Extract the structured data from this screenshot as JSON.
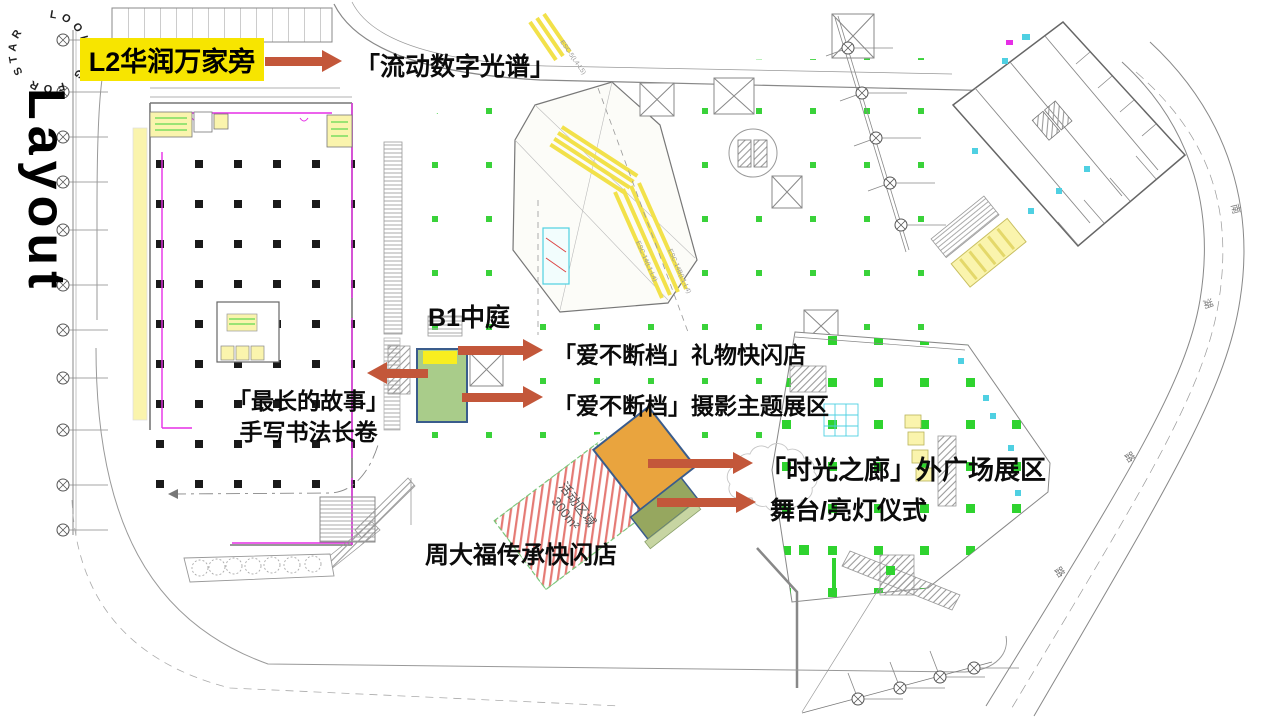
{
  "branding": {
    "circle_text": "LOOKING FOR STAR",
    "side_text": "Layout"
  },
  "colors": {
    "arrow": "#c3573a",
    "highlight": "#f7e500",
    "atrium_green": "#a9cc8a",
    "atrium_border": "#3a5c8c",
    "atrium_yellow": "#f8ee20",
    "corridor_orange": "#e9a43e",
    "stage_green": "#96a75f",
    "stage_strip": "#c7d5a2",
    "hatch_red": "#e0635c",
    "hatch_green": "#7cc87c",
    "cad_magenta": "#e62ee6",
    "cad_green": "#3ad23a",
    "cad_bright_green": "#2fd32f",
    "cad_cyan": "#4fd0e2",
    "cad_yellow": "#f2e14a",
    "cad_yellow_fill": "#faf4ad"
  },
  "annotations": {
    "l2_entry": "L2华润万家旁",
    "digital_spectrum": "「流动数字光谱」",
    "b1_atrium": "B1中庭",
    "gift_popup": "「爱不断档」礼物快闪店",
    "photo_zone": "「爱不断档」摄影主题展区",
    "calligraphy_line1": "「最长的故事」",
    "calligraphy_line2": "手写书法长卷",
    "time_corridor": "「时光之廊」外广场展区",
    "stage": "舞台/亮灯仪式",
    "ctf_popup": "周大福传承快闪店"
  },
  "plan_labels": {
    "activity_area_line1": "活动区域",
    "activity_area_line2": "300m²",
    "activity_dimension": "15600",
    "esc_top": "ESC-5(L4-L5)",
    "esc_mid_a": "ESC-14(L1-L4)",
    "esc_mid_b": "ESC-14B(L1-L4)",
    "road_char_south": "南",
    "road_char_lake": "湖",
    "road_char_road_1": "路",
    "road_char_road_2": "路"
  }
}
